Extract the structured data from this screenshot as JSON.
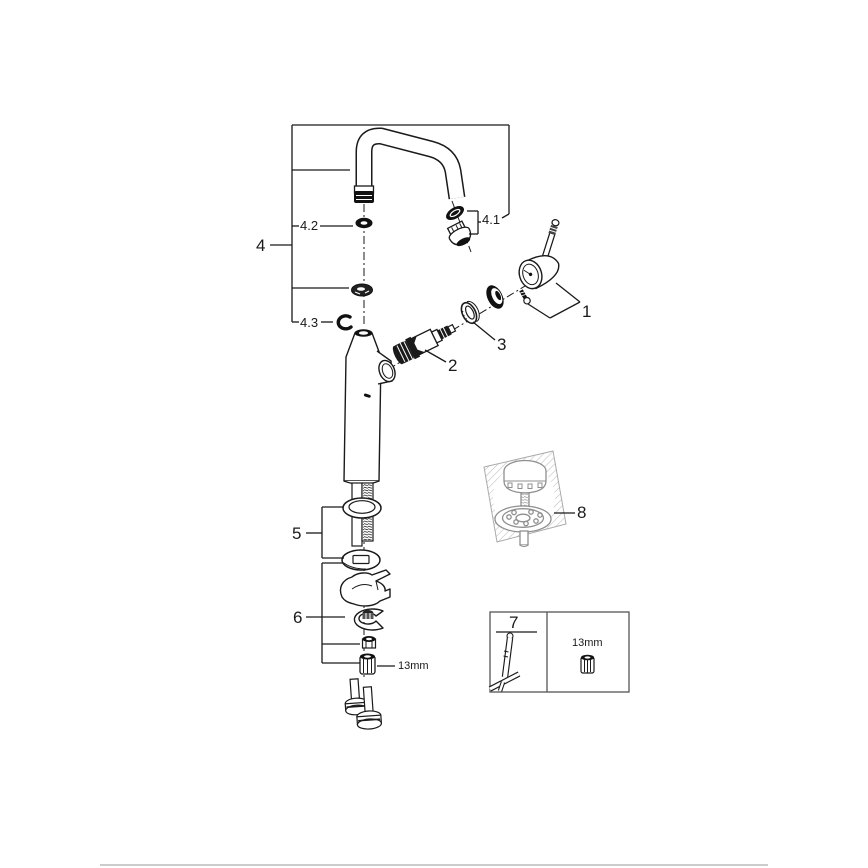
{
  "page": {
    "background": "#ffffff",
    "divider_color": "#cccccc"
  },
  "diagram": {
    "type": "exploded-parts-diagram",
    "colors": {
      "line": "#1a1a1a",
      "secondary_line": "#919191",
      "hatch": "#bdbdbd"
    },
    "callout_labels": {
      "group_4": "4",
      "part_4_1": "4.1",
      "part_4_2": "4.2",
      "part_4_3": "4.3",
      "part_1": "1",
      "part_2": "2",
      "part_3": "3",
      "group_5": "5",
      "group_6": "6",
      "part_8": "8",
      "nut_size": "13mm"
    },
    "tool_box": {
      "number": "7",
      "socket_size": "13mm"
    }
  }
}
